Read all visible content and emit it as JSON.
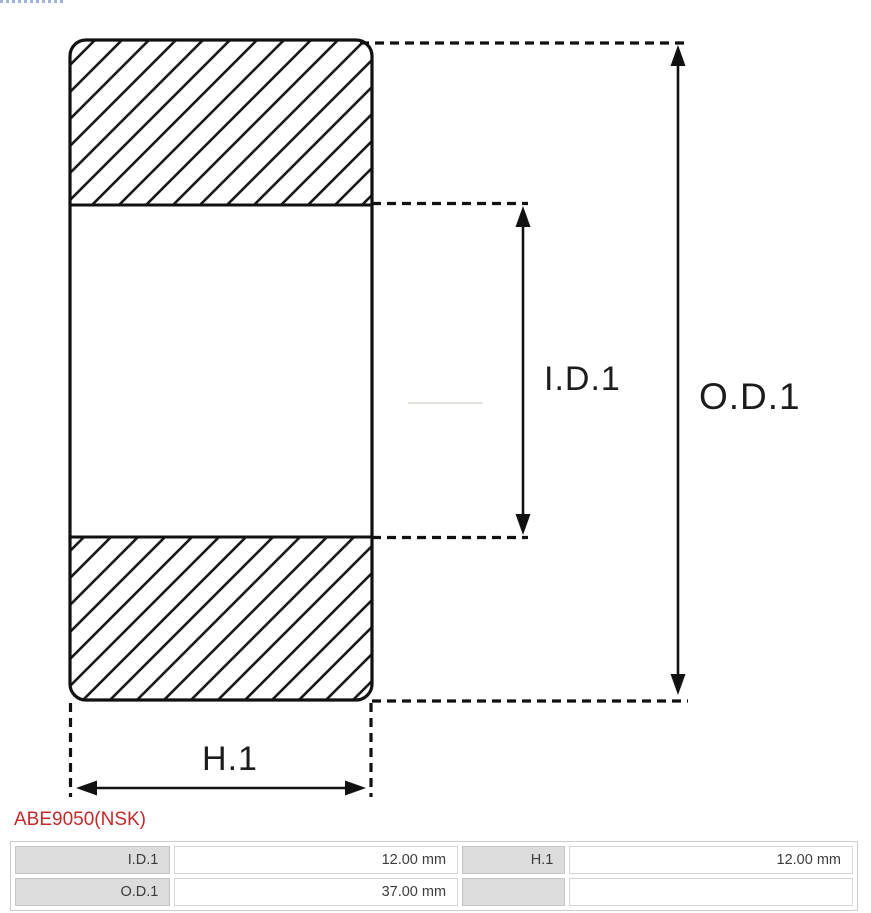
{
  "diagram": {
    "type": "bearing cross-section technical drawing",
    "labels": {
      "inner_diameter": "I.D.1",
      "outer_diameter": "O.D.1",
      "height": "H.1"
    },
    "line_color": "#141414"
  },
  "part": {
    "number": "ABE9050(NSK)",
    "color": "#c22a2a"
  },
  "spec_table": {
    "rows": [
      [
        {
          "label": "I.D.1",
          "value": "12.00 mm"
        },
        {
          "label": "H.1",
          "value": "12.00 mm"
        }
      ],
      [
        {
          "label": "O.D.1",
          "value": "37.00 mm"
        },
        {
          "label": "",
          "value": ""
        }
      ]
    ]
  }
}
